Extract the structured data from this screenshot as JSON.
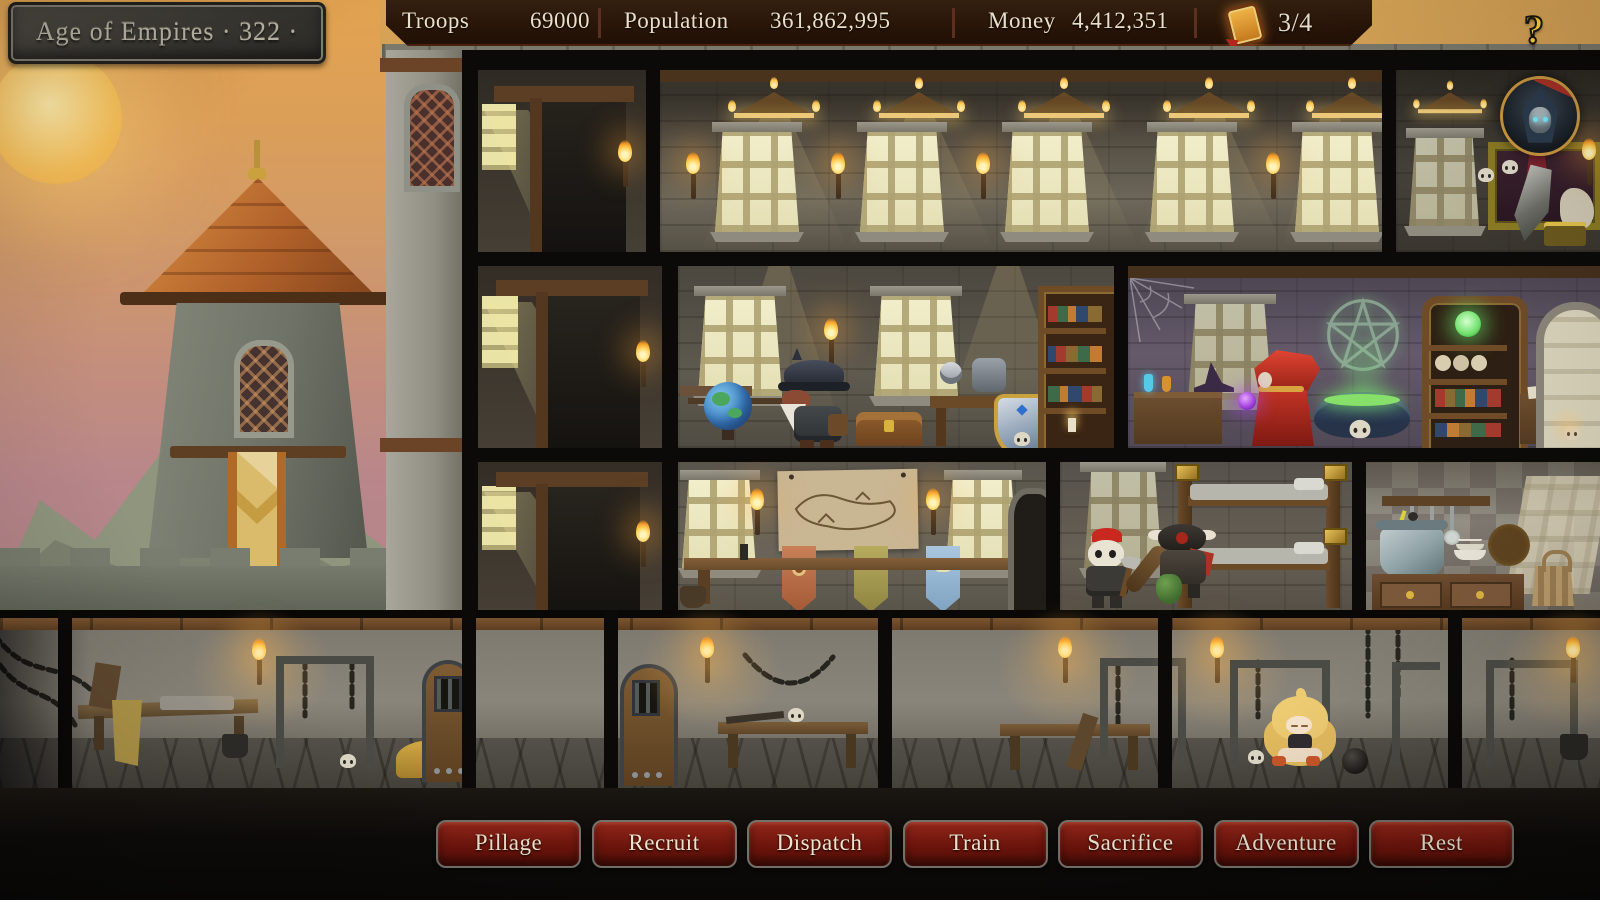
{
  "title_plaque": {
    "text": "Age of Empires · 322 ·"
  },
  "top_bar": {
    "stats": [
      {
        "label": "Troops",
        "value": "69000"
      },
      {
        "label": "Population",
        "value": "361,862,995"
      },
      {
        "label": "Money",
        "value": "4,412,351"
      }
    ],
    "quest_counter": {
      "icon": "quest-scroll-icon",
      "value": "3/4"
    }
  },
  "help_button": {
    "icon": "question-mark-icon",
    "label": "?"
  },
  "action_bar": {
    "buttons": [
      {
        "label": "Pillage"
      },
      {
        "label": "Recruit"
      },
      {
        "label": "Dispatch"
      },
      {
        "label": "Train"
      },
      {
        "label": "Sacrifice"
      },
      {
        "label": "Adventure"
      },
      {
        "label": "Rest"
      }
    ]
  },
  "colors": {
    "top_bar_bg": "#2a170c",
    "plaque_bg": "#3f3c36",
    "button_bg": "#801d12",
    "button_border": "#75726b",
    "button_text": "#efe5cf",
    "sky_top": "#e0a351",
    "sky_bottom": "#b38389",
    "sun": "#f8c868",
    "banner_gold": "#d8b967",
    "torch_flame": "#ffc145",
    "window_glow": "#f0ecc9",
    "help_yellow": "#ffd435",
    "avatar_ring": "#c9963f"
  }
}
